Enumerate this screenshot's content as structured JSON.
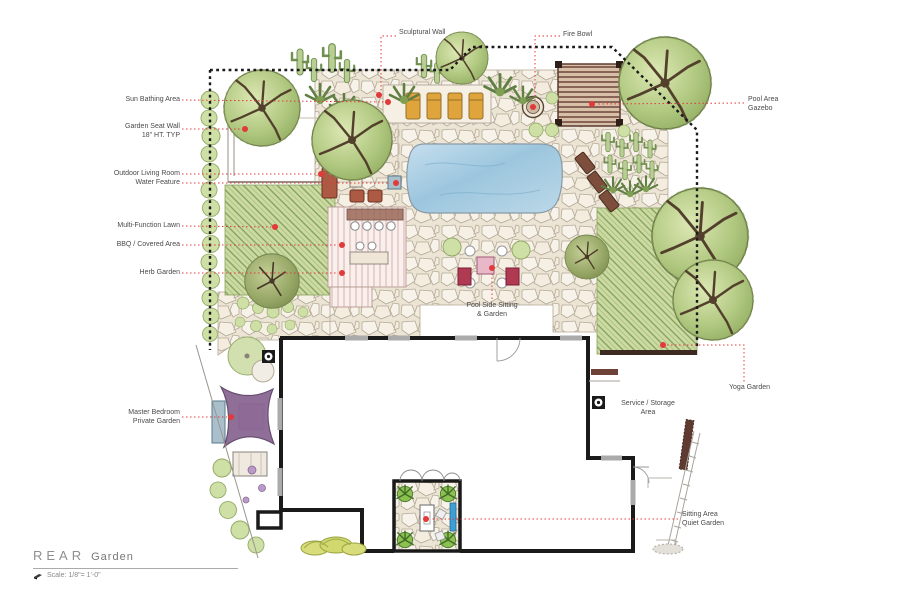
{
  "title_block": {
    "title_main": "REAR",
    "title_sub": "Garden",
    "scale_label": "Scale: 1/8\"= 1'-0\""
  },
  "annotations": {
    "sun_bathing": {
      "line1": "Sun Bathing Area"
    },
    "garden_seat_wall": {
      "line1": "Garden Seat Wall",
      "line2": "18\" HT. TYP"
    },
    "outdoor_living": {
      "line1": "Outdoor Living Room"
    },
    "water_feature": {
      "line1": "Water Feature"
    },
    "multi_function_lawn": {
      "line1": "Multi-Function Lawn"
    },
    "bbq_covered": {
      "line1": "BBQ / Covered Area"
    },
    "herb_garden": {
      "line1": "Herb Garden"
    },
    "master_bedroom": {
      "line1": "Master Bedroom",
      "line2": "Private Garden"
    },
    "sculptural_wall": {
      "line1": "Sculptural Wall"
    },
    "fire_bowl": {
      "line1": "Fire Bowl"
    },
    "pool_area_gazebo": {
      "line1": "Pool Area",
      "line2": "Gazebo"
    },
    "yoga_garden": {
      "line1": "Yoga Garden"
    },
    "pool_side_sitting": {
      "line1": "Pool Side Sitting",
      "line2": "& Garden"
    },
    "service_storage": {
      "line1": "Service / Storage",
      "line2": "Area"
    },
    "sitting_area_quiet": {
      "line1": "Sitting Area",
      "line2": "Quiet Garden"
    }
  },
  "colors": {
    "leader_red": "#e03a3a",
    "pool_blue": "#a9cfe3",
    "lawn_green": "#cddaa4",
    "shade_sail_purple": "#8a6793",
    "lounger_orange": "#dfa43c",
    "wood_brown": "#6e463a",
    "tree_green": "#a8c47f",
    "boundary_black": "#1a1a1a"
  }
}
